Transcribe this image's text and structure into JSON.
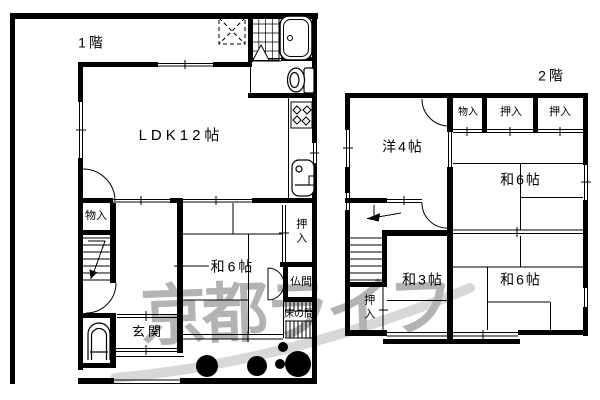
{
  "floor1": {
    "title": "1階",
    "rooms": {
      "ldk": "LDK12帖",
      "washitsu6": "和6帖",
      "genkan": "玄関",
      "monoire": "物入",
      "oshiire": "押入",
      "butsuma": "仏間",
      "tokonoma": "床の間"
    }
  },
  "floor2": {
    "title": "2階",
    "rooms": {
      "youshitsu4": "洋4帖",
      "monoire": "物入",
      "oshiire_a": "押入",
      "oshiire_b": "押入",
      "washitsu6_north": "和6帖",
      "oshiire_west": "押入",
      "washitsu3": "和3帖",
      "washitsu6_south": "和6帖"
    }
  },
  "watermark": "京都ライフ",
  "icons": {
    "bathtub": "bathtub-icon",
    "shower_door": "folding-door-icon",
    "laundry_space": "laundry-space-icon",
    "toilet_upper": "toilet-icon",
    "toilet_lower": "toilet-icon",
    "stove": "gas-stove-icon",
    "sink": "kitchen-sink-icon",
    "stairs_1f": "stairs-icon",
    "stairs_2f": "stairs-icon",
    "trees": "garden-tree-icon"
  },
  "colors": {
    "line": "#000000",
    "background": "#ffffff",
    "watermark": "#b3b3b3",
    "swoosh": "#d8d8d8"
  }
}
